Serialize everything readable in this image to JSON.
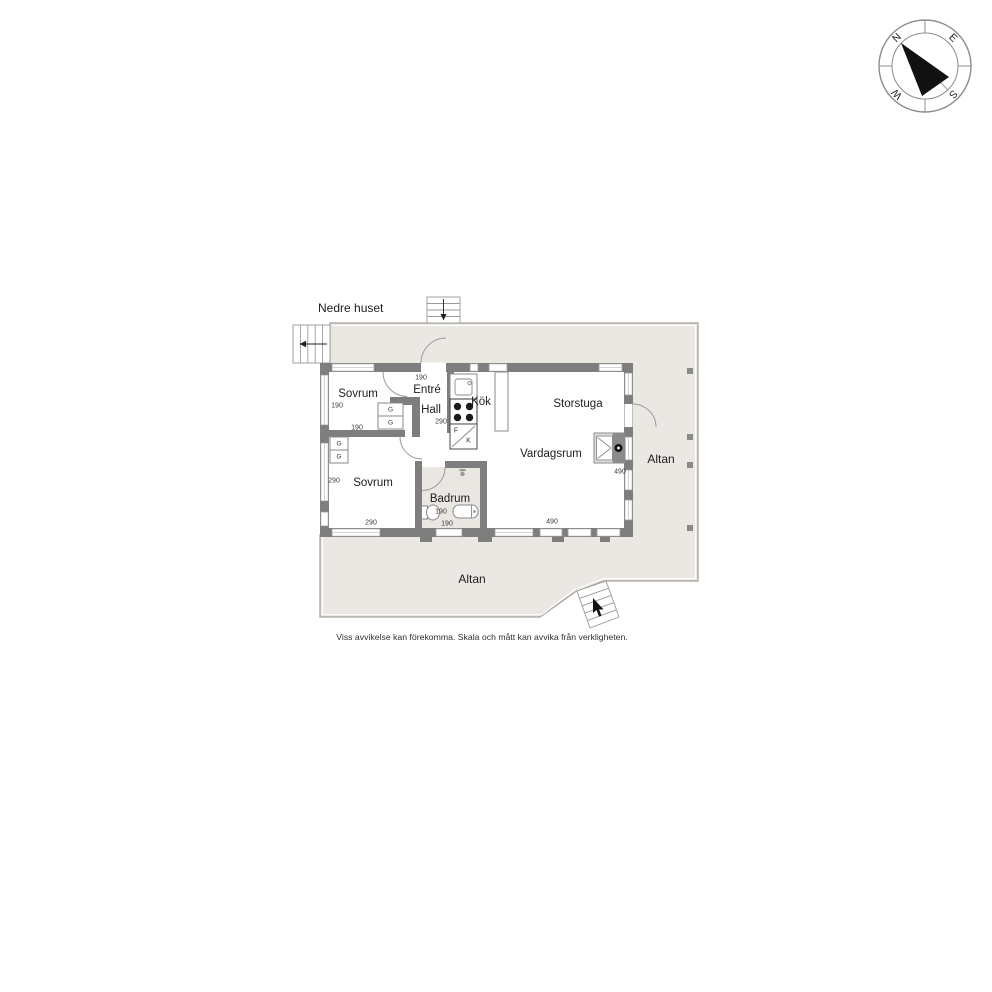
{
  "page": {
    "title": "Nedre huset",
    "disclaimer": "Viss avvikelse kan förekomma. Skala och mått kan avvika från verkligheten."
  },
  "compass": {
    "north": "N",
    "east": "E",
    "south": "S",
    "west": "W"
  },
  "deck": {
    "label_right": "Altan",
    "label_bottom": "Altan"
  },
  "rooms": {
    "sovrum1": {
      "label": "Sovrum",
      "dim_height": "190",
      "dim_width": "190"
    },
    "entre": {
      "label": "Entré",
      "dim_width": "190"
    },
    "hall": {
      "label": "Hall",
      "dim_height": "290"
    },
    "kok": {
      "label": "Kök",
      "fridge": "F",
      "freezer": "K"
    },
    "storstuga": {
      "label": "Storstuga"
    },
    "vardagsrum": {
      "label": "Vardagsrum",
      "dim_height": "490",
      "dim_width": "490"
    },
    "sovrum2": {
      "label": "Sovrum",
      "dim_height": "290",
      "dim_width": "290"
    },
    "badrum": {
      "label": "Badrum",
      "dim_a": "190",
      "dim_b": "190"
    }
  },
  "wardrobe": {
    "label": "G"
  },
  "colors": {
    "wall": "#7e7e7e",
    "deck_fill": "#ebe8e3",
    "bathroom_floor": "#eae7e2",
    "outline": "#9a9a9a",
    "needle": "#111111"
  }
}
